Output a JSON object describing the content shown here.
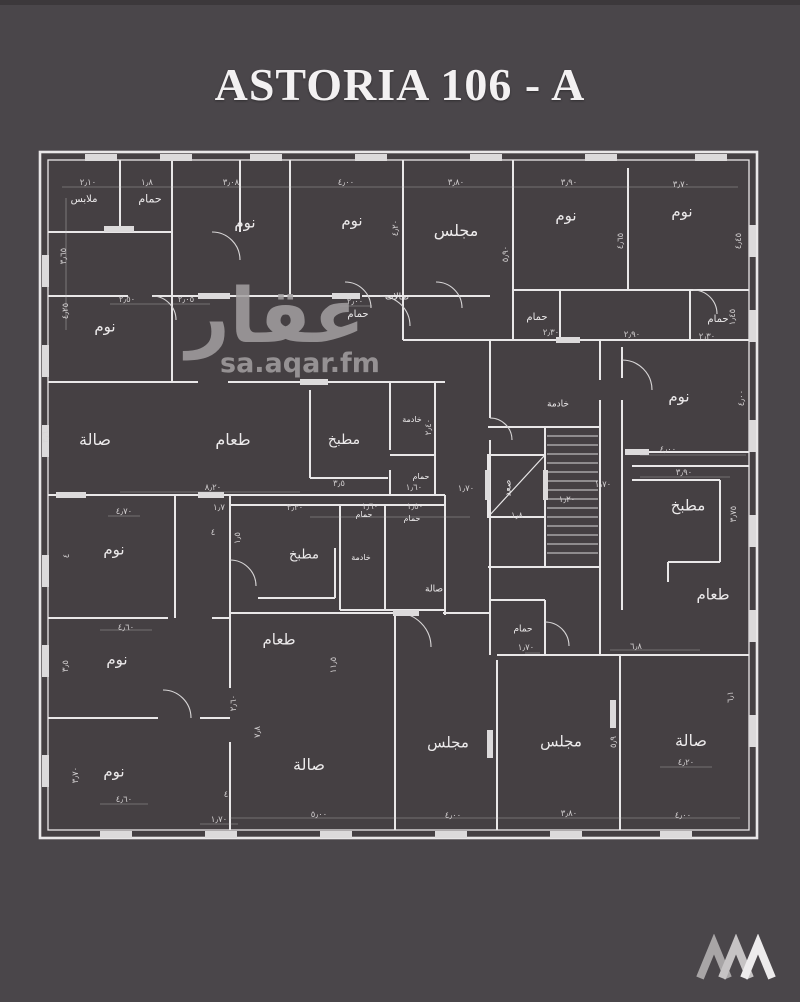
{
  "page": {
    "title": "ASTORIA 106 - A",
    "background_color": "#4a464a",
    "plan_interior_color": "#454043",
    "wall_line_color": "#e9e7e8"
  },
  "watermark": {
    "arabic": "عقار",
    "domain": "sa.aqar.fm"
  },
  "logo": {
    "icon": "zigzag-mountains-logo"
  },
  "floor_plan": {
    "room_labels": [
      {
        "t": "ملابس",
        "x": 84,
        "y": 200,
        "s": 10
      },
      {
        "t": "حمام",
        "x": 150,
        "y": 199,
        "s": 11
      },
      {
        "t": "نوم",
        "x": 245,
        "y": 223,
        "s": 15
      },
      {
        "t": "نوم",
        "x": 352,
        "y": 221,
        "s": 15
      },
      {
        "t": "مجلس",
        "x": 456,
        "y": 231,
        "s": 16
      },
      {
        "t": "نوم",
        "x": 566,
        "y": 216,
        "s": 15
      },
      {
        "t": "نوم",
        "x": 682,
        "y": 212,
        "s": 15
      },
      {
        "t": "نوم",
        "x": 105,
        "y": 327,
        "s": 15
      },
      {
        "t": "حمام",
        "x": 358,
        "y": 315,
        "s": 10
      },
      {
        "t": "صالات",
        "x": 397,
        "y": 298,
        "s": 9
      },
      {
        "t": "حمام",
        "x": 537,
        "y": 318,
        "s": 10
      },
      {
        "t": "حمام",
        "x": 718,
        "y": 320,
        "s": 10
      },
      {
        "t": "خادمة",
        "x": 558,
        "y": 405,
        "s": 9
      },
      {
        "t": "نوم",
        "x": 679,
        "y": 397,
        "s": 15
      },
      {
        "t": "صالة",
        "x": 95,
        "y": 440,
        "s": 16
      },
      {
        "t": "طعام",
        "x": 233,
        "y": 440,
        "s": 16
      },
      {
        "t": "مطبخ",
        "x": 344,
        "y": 440,
        "s": 14
      },
      {
        "t": "خادمة",
        "x": 412,
        "y": 420,
        "s": 8
      },
      {
        "t": "حمام",
        "x": 421,
        "y": 477,
        "s": 8
      },
      {
        "t": "صعد",
        "x": 509,
        "y": 488,
        "s": 9,
        "r": -90
      },
      {
        "t": "مطبخ",
        "x": 688,
        "y": 506,
        "s": 15
      },
      {
        "t": "طعام",
        "x": 713,
        "y": 595,
        "s": 15
      },
      {
        "t": "نوم",
        "x": 114,
        "y": 550,
        "s": 15
      },
      {
        "t": "نوم",
        "x": 117,
        "y": 660,
        "s": 15
      },
      {
        "t": "نوم",
        "x": 114,
        "y": 772,
        "s": 15
      },
      {
        "t": "مطبخ",
        "x": 304,
        "y": 555,
        "s": 13
      },
      {
        "t": "حمام",
        "x": 364,
        "y": 515,
        "s": 8
      },
      {
        "t": "خادمة",
        "x": 361,
        "y": 558,
        "s": 8
      },
      {
        "t": "حمام",
        "x": 412,
        "y": 519,
        "s": 8
      },
      {
        "t": "صالة",
        "x": 434,
        "y": 590,
        "s": 9
      },
      {
        "t": "طعام",
        "x": 279,
        "y": 640,
        "s": 15
      },
      {
        "t": "صالة",
        "x": 309,
        "y": 765,
        "s": 16
      },
      {
        "t": "مجلس",
        "x": 448,
        "y": 743,
        "s": 15
      },
      {
        "t": "حمام",
        "x": 523,
        "y": 630,
        "s": 9
      },
      {
        "t": "مجلس",
        "x": 561,
        "y": 742,
        "s": 15
      },
      {
        "t": "صالة",
        "x": 691,
        "y": 741,
        "s": 16
      }
    ],
    "dimension_labels": [
      {
        "t": "٢٫١٠",
        "x": 88,
        "y": 183
      },
      {
        "t": "١٫٨",
        "x": 147,
        "y": 183
      },
      {
        "t": "٣٫٠٨",
        "x": 231,
        "y": 183
      },
      {
        "t": "٤٫٠٠",
        "x": 346,
        "y": 183
      },
      {
        "t": "٣٫٨٠",
        "x": 456,
        "y": 183
      },
      {
        "t": "٣٫٩٠",
        "x": 569,
        "y": 183
      },
      {
        "t": "٣٫٧٠",
        "x": 681,
        "y": 185
      },
      {
        "t": "٣٫٦٥",
        "x": 64,
        "y": 256,
        "r": -90
      },
      {
        "t": "٤٫٢٥",
        "x": 66,
        "y": 311,
        "r": -90
      },
      {
        "t": "٣٫٦",
        "x": 46,
        "y": 437,
        "r": -90
      },
      {
        "t": "٢٫٥٠",
        "x": 127,
        "y": 300
      },
      {
        "t": "٢٫٠٥",
        "x": 186,
        "y": 300
      },
      {
        "t": "٢٫٠٠",
        "x": 355,
        "y": 302
      },
      {
        "t": "٤٫٢٠",
        "x": 396,
        "y": 228,
        "r": -90
      },
      {
        "t": "٥٫٩٠",
        "x": 506,
        "y": 254,
        "r": -90
      },
      {
        "t": "٤٫٦٥",
        "x": 621,
        "y": 241,
        "r": -90
      },
      {
        "t": "٤٫٤٥",
        "x": 739,
        "y": 241,
        "r": -90
      },
      {
        "t": "٢٫٣٠",
        "x": 551,
        "y": 333
      },
      {
        "t": "٢٫٩٠",
        "x": 632,
        "y": 335
      },
      {
        "t": "٢٫٣٠",
        "x": 707,
        "y": 337
      },
      {
        "t": "١٫٤٥",
        "x": 733,
        "y": 317,
        "r": -90
      },
      {
        "t": "٤٫٠٠",
        "x": 742,
        "y": 398,
        "r": -90
      },
      {
        "t": "٨٫٢٠",
        "x": 213,
        "y": 488
      },
      {
        "t": "٣٫٥",
        "x": 339,
        "y": 484
      },
      {
        "t": "١٫٦٠",
        "x": 414,
        "y": 488
      },
      {
        "t": "١٫٧٠",
        "x": 466,
        "y": 489
      },
      {
        "t": "٢٫٤٠",
        "x": 429,
        "y": 427,
        "r": -90
      },
      {
        "t": "١٫٢٠",
        "x": 567,
        "y": 500
      },
      {
        "t": "١٫٧٠",
        "x": 603,
        "y": 485
      },
      {
        "t": "١٫٨",
        "x": 517,
        "y": 516
      },
      {
        "t": "٤٫٠٠",
        "x": 668,
        "y": 450
      },
      {
        "t": "٣٫٩٠",
        "x": 684,
        "y": 473
      },
      {
        "t": "٣٫٧٥",
        "x": 734,
        "y": 514,
        "r": -90
      },
      {
        "t": "٤٫٧٠",
        "x": 124,
        "y": 512
      },
      {
        "t": "١٫٧",
        "x": 219,
        "y": 508
      },
      {
        "t": "١٫٥",
        "x": 238,
        "y": 538,
        "r": -90
      },
      {
        "t": "٤",
        "x": 213,
        "y": 533
      },
      {
        "t": "٤",
        "x": 67,
        "y": 556,
        "r": -90
      },
      {
        "t": "٣٫٣٠",
        "x": 295,
        "y": 508
      },
      {
        "t": "١٫٦٠",
        "x": 370,
        "y": 507
      },
      {
        "t": "١٫٥٠",
        "x": 415,
        "y": 507
      },
      {
        "t": "٤٫٦٠",
        "x": 126,
        "y": 628
      },
      {
        "t": "٣٫٥",
        "x": 66,
        "y": 666,
        "r": -90
      },
      {
        "t": "٢٫٦٠",
        "x": 234,
        "y": 703,
        "r": -90
      },
      {
        "t": "٧٫٨",
        "x": 258,
        "y": 732,
        "r": -90
      },
      {
        "t": "١١٫٥",
        "x": 334,
        "y": 665,
        "r": -90
      },
      {
        "t": "٣٫٧٠",
        "x": 76,
        "y": 775,
        "r": -90
      },
      {
        "t": "٤٫٦٠",
        "x": 124,
        "y": 800
      },
      {
        "t": "١٫٧٠",
        "x": 219,
        "y": 820
      },
      {
        "t": "٤",
        "x": 226,
        "y": 795
      },
      {
        "t": "٦٫٨",
        "x": 636,
        "y": 647
      },
      {
        "t": "١٫٧٠",
        "x": 526,
        "y": 648
      },
      {
        "t": "٥٫٩",
        "x": 614,
        "y": 742,
        "r": -90
      },
      {
        "t": "٦٫١",
        "x": 731,
        "y": 697,
        "r": -90
      },
      {
        "t": "٤٫٢٠",
        "x": 686,
        "y": 763
      },
      {
        "t": "٥٫٠٠",
        "x": 319,
        "y": 815
      },
      {
        "t": "٤٫٠٠",
        "x": 453,
        "y": 816
      },
      {
        "t": "٣٫٨٠",
        "x": 569,
        "y": 814
      },
      {
        "t": "٤٫٠٠",
        "x": 683,
        "y": 816
      }
    ]
  }
}
